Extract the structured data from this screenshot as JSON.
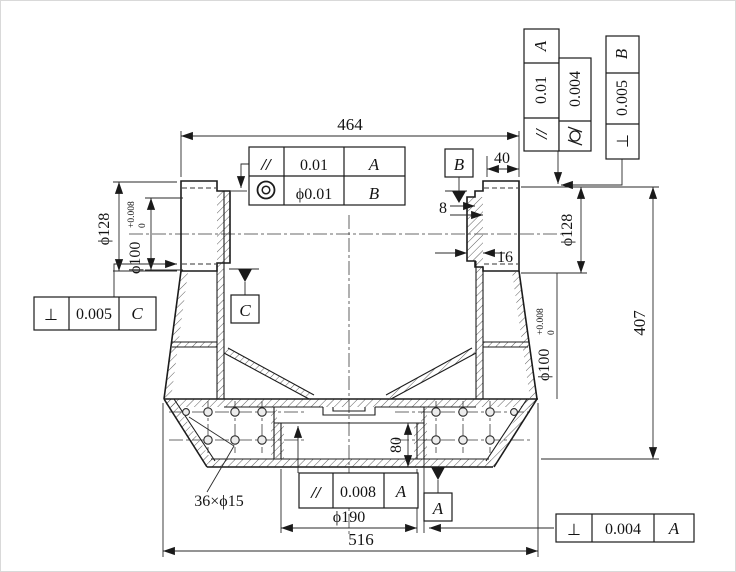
{
  "dims": {
    "overall_top": "464",
    "overall_bottom": "516",
    "height_right": "407",
    "boss_top_width": "40",
    "step_small": "8",
    "step_large": "16",
    "recess_depth": "80",
    "base_bore": "ϕ190",
    "left_boss_od": "ϕ128",
    "right_boss_od": "ϕ128",
    "left_bore": {
      "text": "ϕ100",
      "tol_up": "+0.008",
      "tol_dn": "0"
    },
    "right_bore": {
      "text": "ϕ100",
      "tol_up": "+0.008",
      "tol_dn": "0"
    },
    "holes_note": "36×ϕ15"
  },
  "fcf": {
    "top": {
      "rows": [
        {
          "sym": "//",
          "val": "0.01",
          "datum": "A"
        },
        {
          "sym": "◎",
          "val": "ϕ0.01",
          "datum": "B"
        }
      ]
    },
    "vert_parallel": {
      "sym": "//",
      "val": "0.01",
      "datum": "A"
    },
    "vert_cyl": {
      "sym": "⌭",
      "val": "0.004"
    },
    "vert_perp": {
      "sym": "⊥",
      "val": "0.005",
      "datum": "B"
    },
    "left_perp": {
      "sym": "⊥",
      "val": "0.005",
      "datum": "C"
    },
    "bottom_parallel": {
      "sym": "//",
      "val": "0.008",
      "datum": "A"
    },
    "bottom_perp": {
      "sym": "⊥",
      "val": "0.004",
      "datum": "A"
    }
  },
  "datums": {
    "a": "A",
    "b": "B",
    "c": "C"
  }
}
